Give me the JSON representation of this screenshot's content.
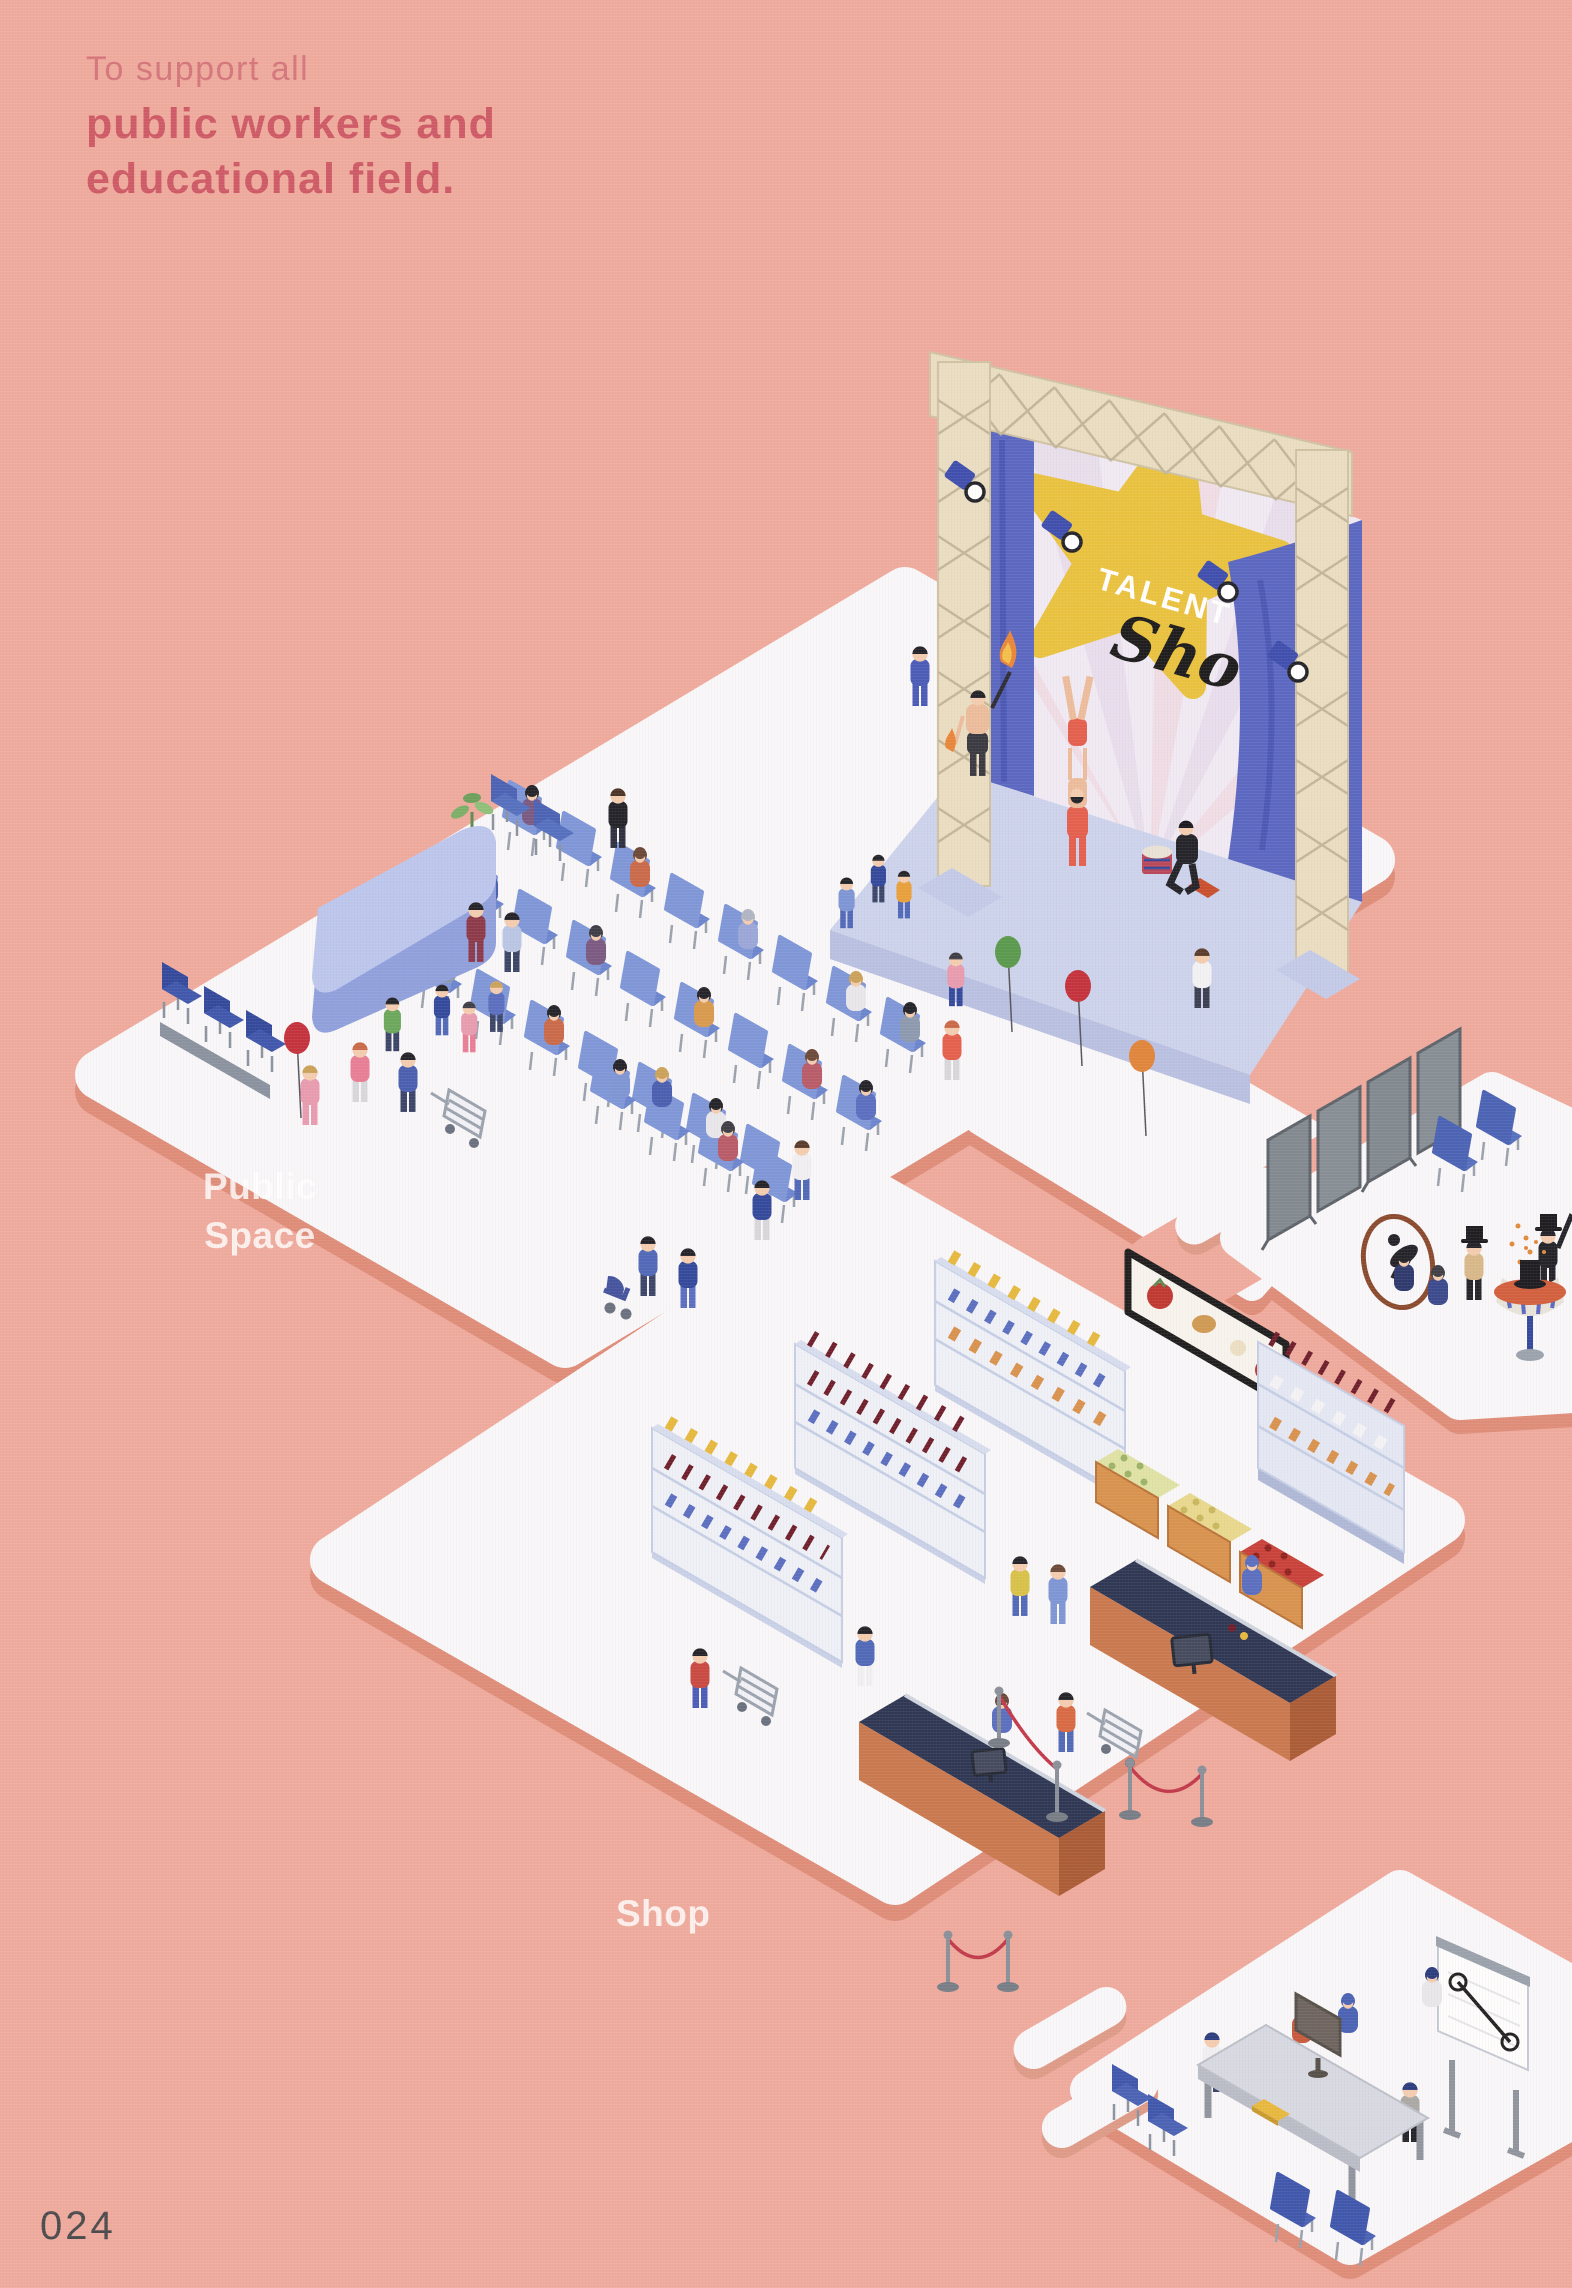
{
  "page": {
    "number": "024",
    "background_color": "#eeab9d",
    "platform_color": "#f8f7f9",
    "shadow_color": "#de8d79"
  },
  "heading": {
    "intro": "To support all",
    "line1": "public workers and",
    "line2": "educational field.",
    "color": "#cd5a66"
  },
  "zones": {
    "public_space": {
      "label_line1": "Public",
      "label_line2": "Space"
    },
    "shop": {
      "label": "Shop"
    }
  },
  "stage_banner": {
    "word1": "TALENT",
    "word2": "Show",
    "star_color": "#e9c33f",
    "curtain_color": "#5a68c2"
  },
  "palette": {
    "chair_blue": "#7e97d8",
    "counter_orange": "#c9794f",
    "belt_navy": "#2e3754",
    "truss_beige": "#eadec2",
    "rope_red": "#c13a4b",
    "stage_floor": "#ccd3ec"
  }
}
